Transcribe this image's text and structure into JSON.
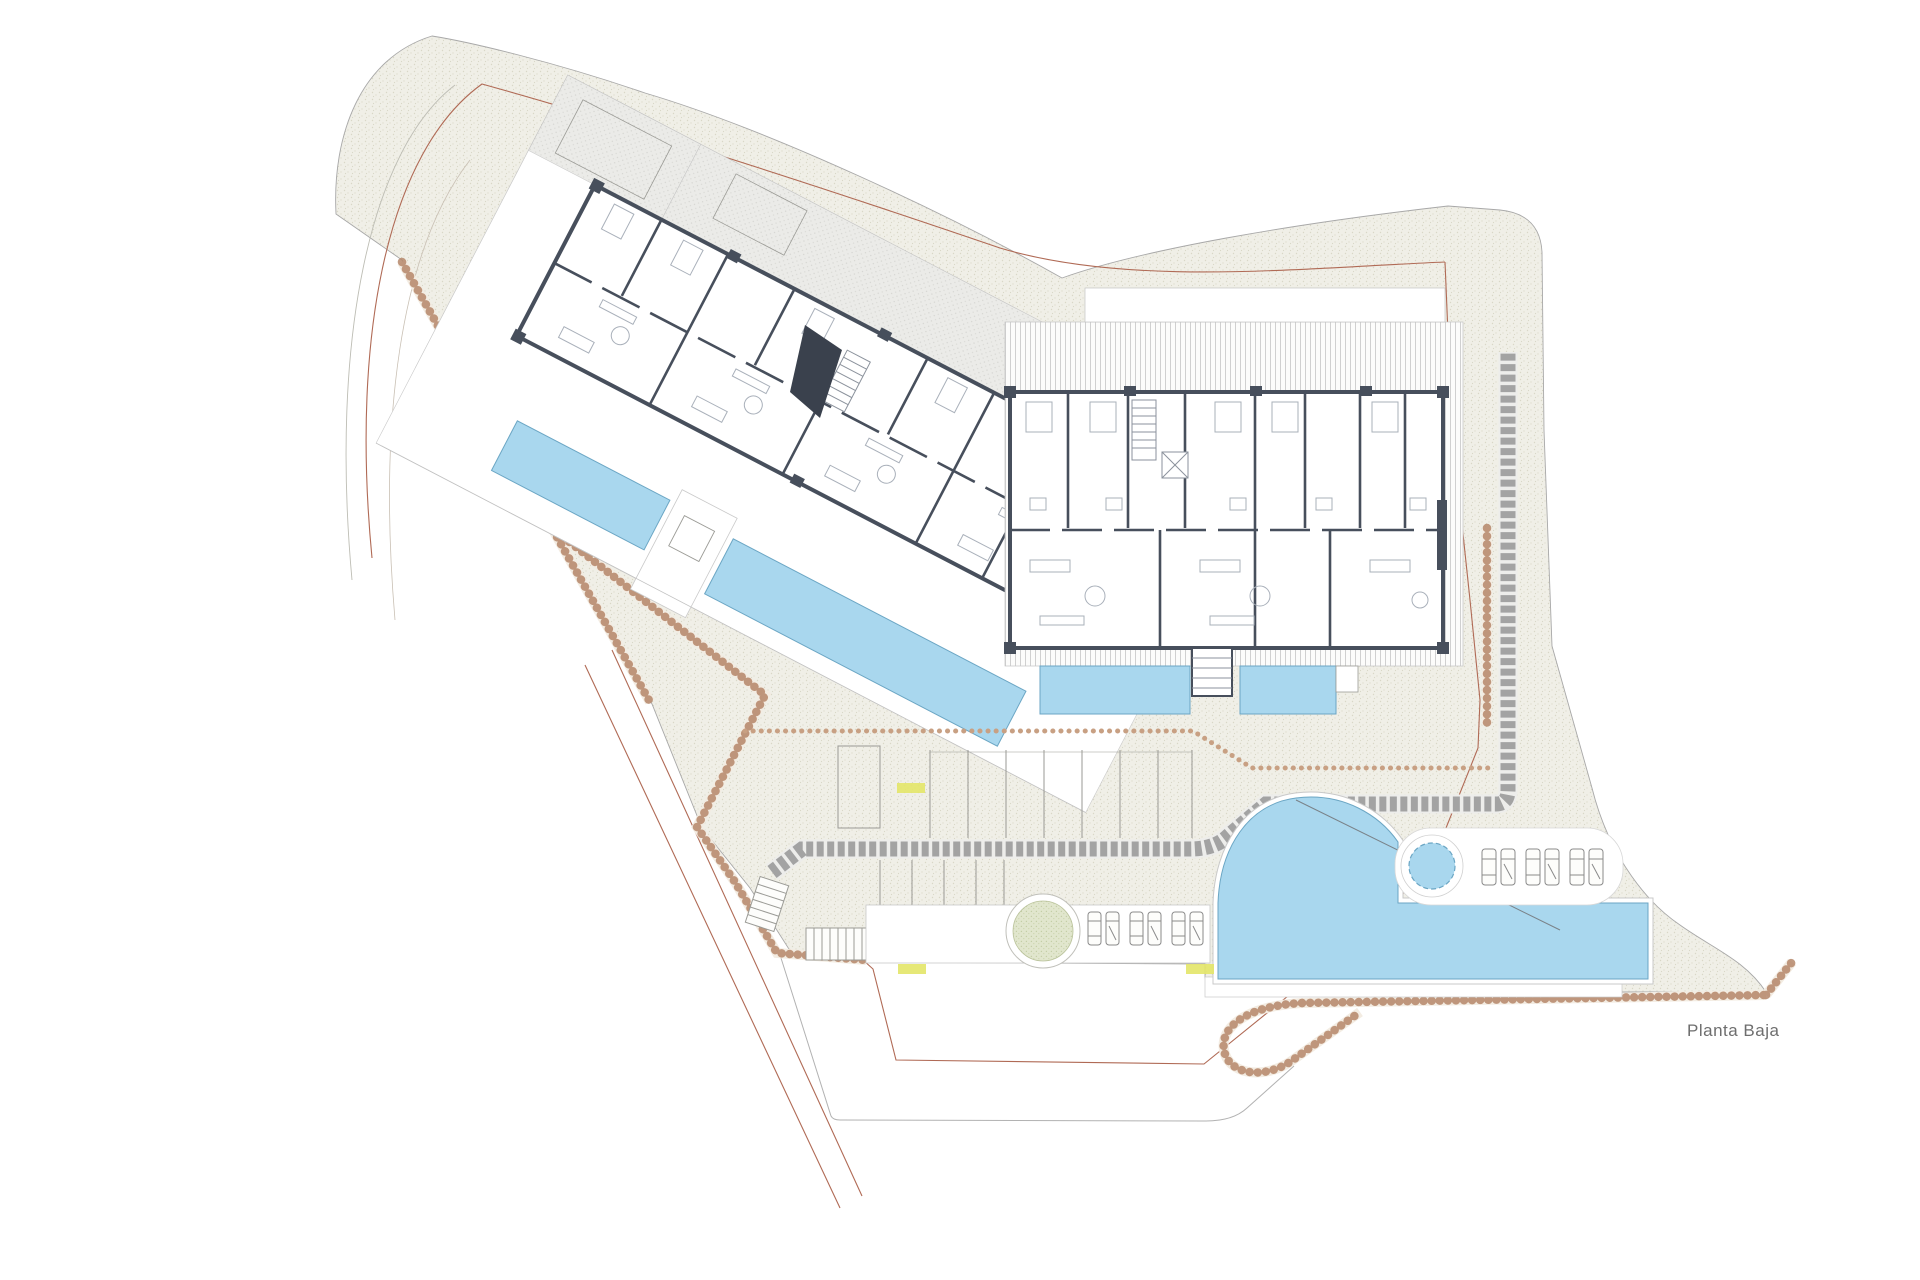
{
  "drawing": {
    "title": "Planta Baja",
    "colors": {
      "background": "#ffffff",
      "site_fill": "#f0efe7",
      "site_texture": "#d9d7c7",
      "outline": "#a8a8a8",
      "wall": "#474f5c",
      "pool_fill": "#a9d7ee",
      "pool_edge": "#6ba6c4",
      "paver": "#a3a3a3",
      "stone_border": "#b5876a",
      "setback_line": "#b06a55",
      "deck_line": "#c6c6c6",
      "tree_fill": "#dfe5cb",
      "elevation_marker": "#e3e568",
      "title_color": "#6e6e6e"
    },
    "inventory": {
      "buildings": 2,
      "linear_pools": 4,
      "main_pool": 1,
      "spa_circle": 1,
      "tree_circle": 1,
      "sun_loungers_lower_terrace": 6,
      "sun_loungers_pool_terrace": 6,
      "elevation_markers": 3,
      "stair_flights": 3
    },
    "labels": {
      "title": "Planta Baja",
      "elevation_markers": [
        "",
        "",
        ""
      ]
    }
  }
}
